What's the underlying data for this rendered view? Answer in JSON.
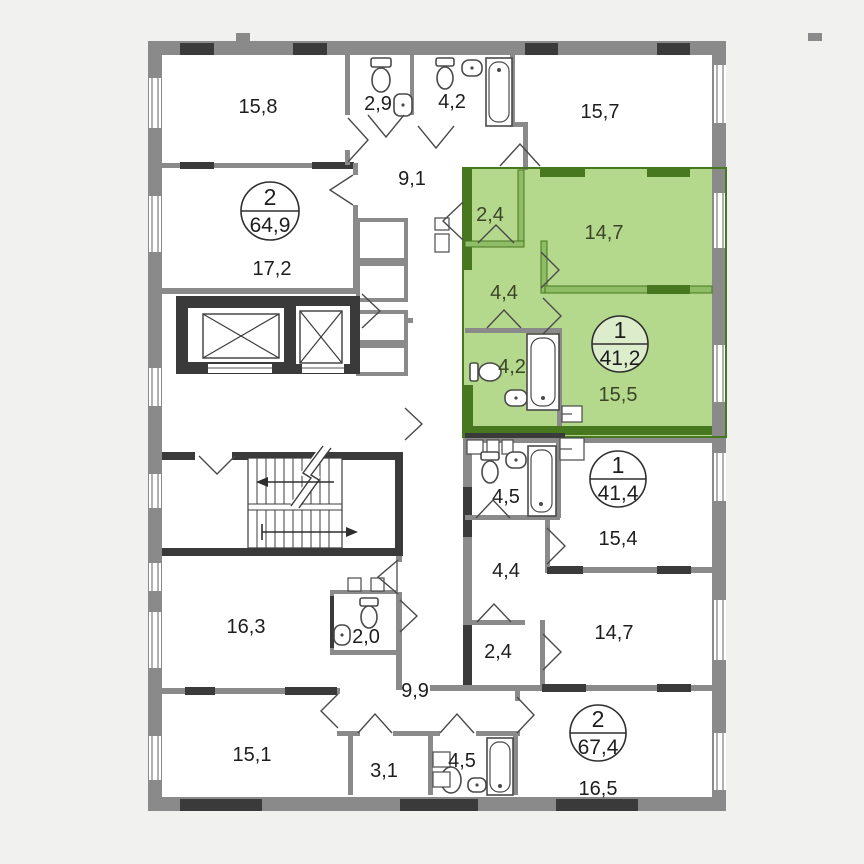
{
  "plan": {
    "highlight_color": "#b4d88c",
    "highlight_wall_color": "#47781f",
    "wall_color": "#8a8a8a",
    "dark_wall_color": "#3a3a3a"
  },
  "units": {
    "top_left": {
      "type": "2",
      "area": "64,9",
      "rooms": {
        "bedroom": "15,8",
        "wc": "2,9",
        "bathroom": "4,2",
        "hallway": "9,1",
        "living": "17,2"
      }
    },
    "highlighted": {
      "type": "1",
      "area": "41,2",
      "rooms": {
        "entry": "2,4",
        "bedroom": "14,7",
        "hallway": "4,4",
        "bathroom": "4,2",
        "living": "15,5"
      }
    },
    "mid_right": {
      "type": "1",
      "area": "41,4",
      "rooms": {
        "bathroom": "4,5",
        "living": "15,4",
        "hallway": "4,4",
        "entry": "2,4",
        "bedroom": "14,7"
      }
    },
    "bottom_right": {
      "type": "2",
      "area": "67,4",
      "rooms": {
        "living": "16,5",
        "bathroom": "4,5"
      }
    },
    "bottom_left": {
      "rooms": {
        "bedroom": "16,3",
        "wc": "2,0",
        "hallway": "9,9",
        "living": "15,1",
        "entry": "3,1"
      }
    },
    "top_right_room": "15,7"
  }
}
